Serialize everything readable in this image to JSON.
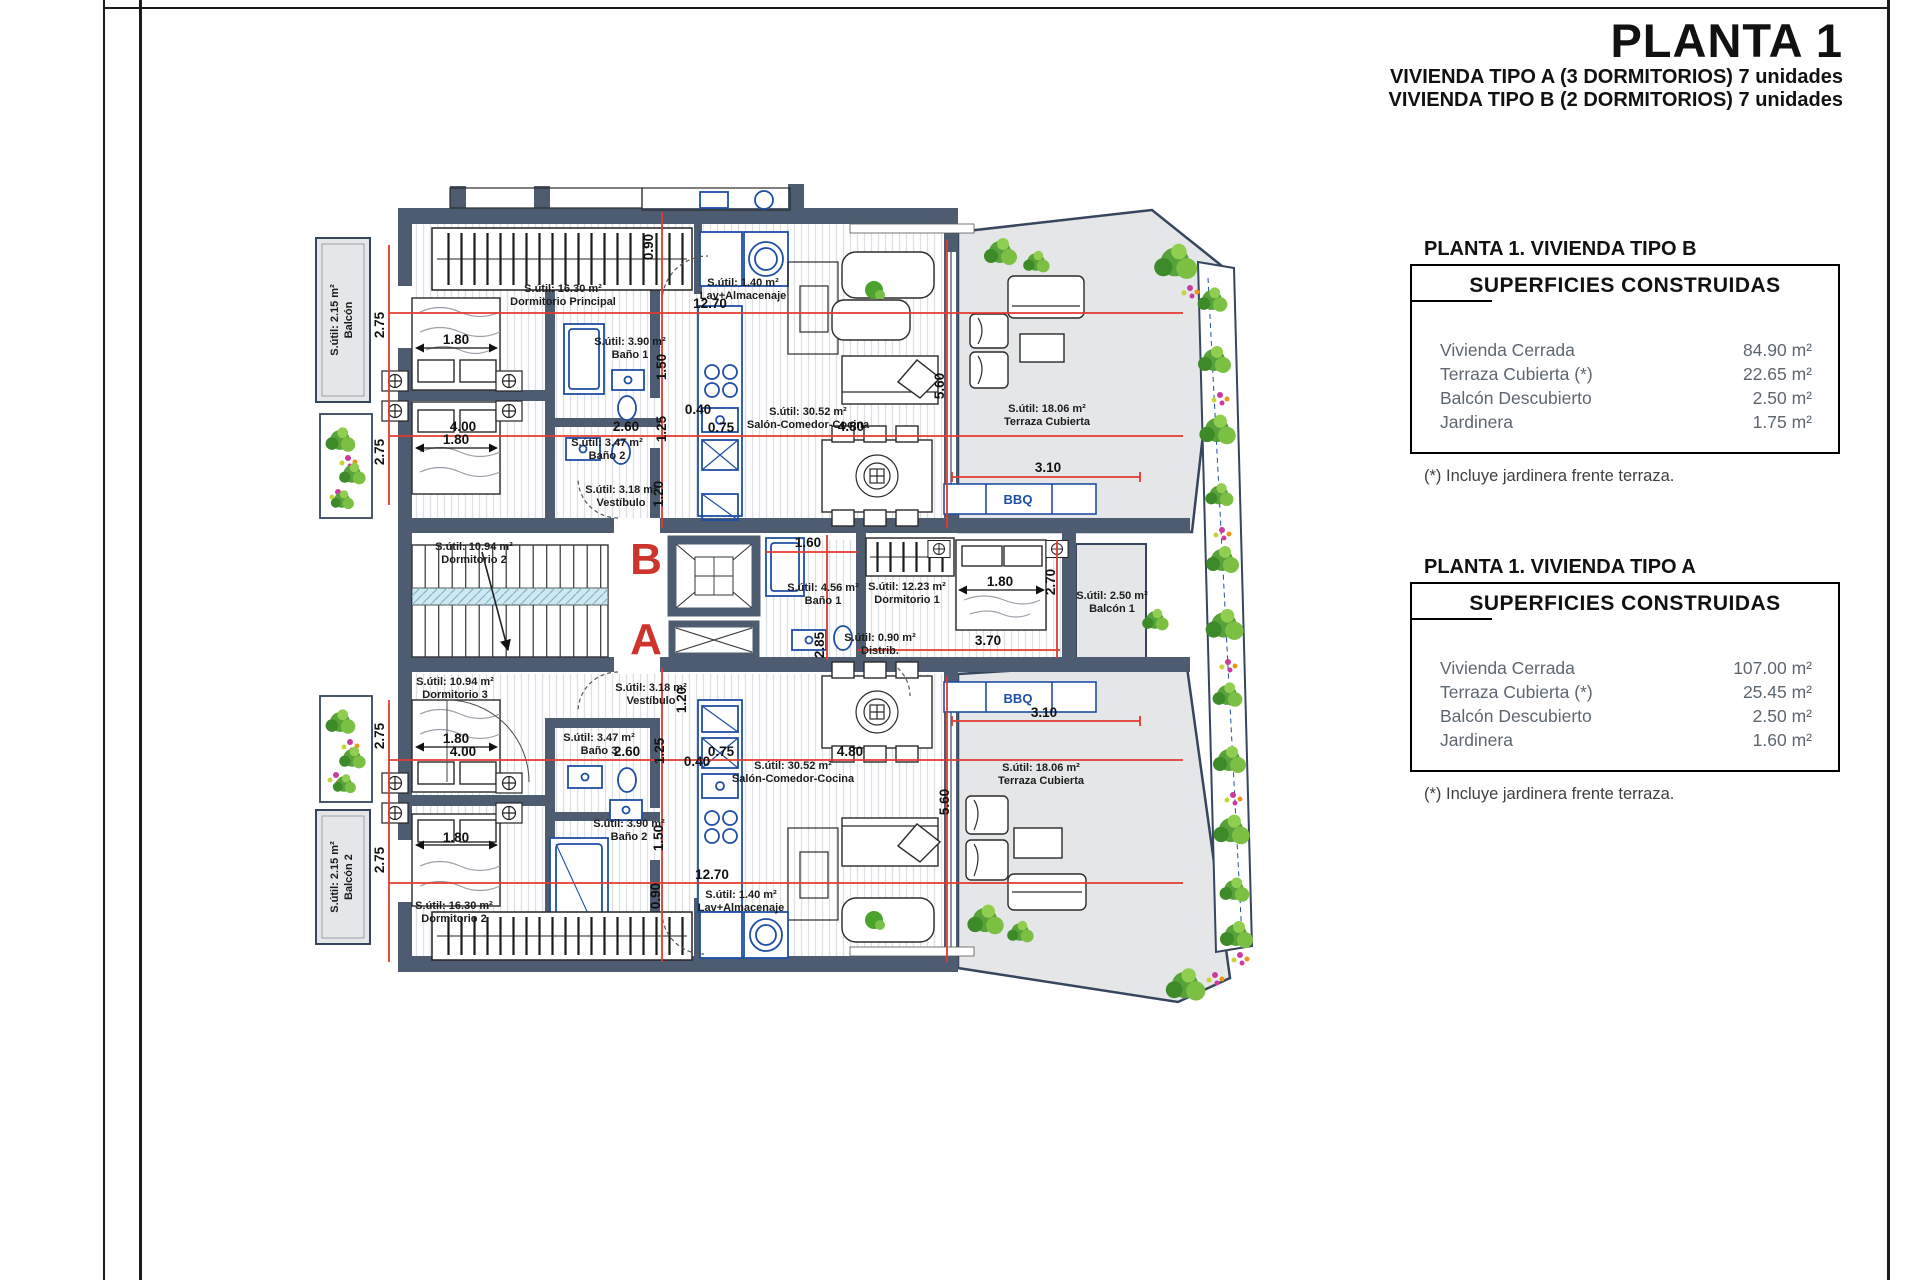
{
  "title_block": {
    "title": "PLANTA 1",
    "subtitle_a": "VIVIENDA TIPO A (3 DORMITORIOS) 7 unidades",
    "subtitle_b": "VIVIENDA TIPO B (2 DORMITORIOS) 7 unidades"
  },
  "tables": [
    {
      "heading": "PLANTA 1. VIVIENDA TIPO B",
      "box_title": "SUPERFICIES CONSTRUIDAS",
      "rows": [
        {
          "label": "Vivienda Cerrada",
          "value": "84.90 m²"
        },
        {
          "label": "Terraza Cubierta (*)",
          "value": "22.65 m²"
        },
        {
          "label": "Balcón Descubierto",
          "value": "2.50 m²"
        },
        {
          "label": "Jardinera",
          "value": "1.75 m²"
        }
      ],
      "footnote": "(*) Incluye jardinera frente terraza."
    },
    {
      "heading": "PLANTA 1. VIVIENDA TIPO A",
      "box_title": "SUPERFICIES CONSTRUIDAS",
      "rows": [
        {
          "label": "Vivienda Cerrada",
          "value": "107.00 m²"
        },
        {
          "label": "Terraza Cubierta (*)",
          "value": "25.45 m²"
        },
        {
          "label": "Balcón Descubierto",
          "value": "2.50 m²"
        },
        {
          "label": "Jardinera",
          "value": "1.60 m²"
        }
      ],
      "footnote": "(*) Incluye jardinera frente terraza."
    }
  ],
  "plan": {
    "unit_letters": [
      {
        "t": "B",
        "x": 646,
        "y": 574
      },
      {
        "t": "A",
        "x": 646,
        "y": 654
      }
    ],
    "bbq": [
      {
        "t": "BBQ",
        "x": 1018,
        "y": 504
      },
      {
        "t": "BBQ",
        "x": 1018,
        "y": 703
      }
    ],
    "vlabels": [
      {
        "l1": "Balcón",
        "l2": "S.útil: 2.15 m²",
        "x": 345,
        "y": 320
      },
      {
        "l1": "Balcón 2",
        "l2": "S.útil: 2.15 m²",
        "x": 345,
        "y": 877
      }
    ],
    "rooms": [
      {
        "a": "S.útil: 16.30 m²",
        "n": "Dormitorio Principal",
        "x": 563,
        "y": 292
      },
      {
        "a": "S.útil: 1.40 m²",
        "n": "Lav+Almacenaje",
        "x": 743,
        "y": 286
      },
      {
        "a": "S.útil: 3.90 m²",
        "n": "Baño 1",
        "x": 630,
        "y": 345
      },
      {
        "a": "S.útil: 3.47 m²",
        "n": "Baño 2",
        "x": 607,
        "y": 446
      },
      {
        "a": "S.útil: 30.52 m²",
        "n": "Salón-Comedor-Cocina",
        "x": 808,
        "y": 415
      },
      {
        "a": "S.útil: 18.06 m²",
        "n": "Terraza Cubierta",
        "x": 1047,
        "y": 412
      },
      {
        "a": "S.útil: 10.94 m²",
        "n": "Dormitorio 2",
        "x": 474,
        "y": 550
      },
      {
        "a": "S.útil: 3.18 m²",
        "n": "Vestíbulo",
        "x": 621,
        "y": 493
      },
      {
        "a": "S.útil: 4.56 m²",
        "n": "Baño 1",
        "x": 823,
        "y": 591
      },
      {
        "a": "S.útil: 12.23 m²",
        "n": "Dormitorio 1",
        "x": 907,
        "y": 590
      },
      {
        "a": "S.útil: 0.90 m²",
        "n": "Distrib.",
        "x": 880,
        "y": 641
      },
      {
        "a": "S.útil: 2.50 m²",
        "n": "Balcón 1",
        "x": 1112,
        "y": 599
      },
      {
        "a": "S.útil: 10.94 m²",
        "n": "Dormitorio 3",
        "x": 455,
        "y": 685
      },
      {
        "a": "S.útil: 3.18 m²",
        "n": "Vestíbulo",
        "x": 651,
        "y": 691
      },
      {
        "a": "S.útil: 3.47 m²",
        "n": "Baño 3",
        "x": 599,
        "y": 741
      },
      {
        "a": "S.útil: 3.90 m²",
        "n": "Baño 2",
        "x": 629,
        "y": 827
      },
      {
        "a": "S.útil: 30.52 m²",
        "n": "Salón-Comedor-Cocina",
        "x": 793,
        "y": 769
      },
      {
        "a": "S.útil: 18.06 m²",
        "n": "Terraza Cubierta",
        "x": 1041,
        "y": 771
      },
      {
        "a": "S.útil: 1.40 m²",
        "n": "Lav+Almacenaje",
        "x": 741,
        "y": 898
      },
      {
        "a": "S.útil: 16.30 m²",
        "n": "Dormitorio 2",
        "x": 454,
        "y": 909
      }
    ],
    "dims": [
      {
        "t": "12.70",
        "x": 710,
        "y": 308
      },
      {
        "t": "0.90",
        "x": 653,
        "y": 247,
        "r": -90
      },
      {
        "t": "2.75",
        "x": 384,
        "y": 325,
        "r": -90
      },
      {
        "t": "1.80",
        "x": 456,
        "y": 344
      },
      {
        "t": "1.50",
        "x": 666,
        "y": 367,
        "r": -90
      },
      {
        "t": "0.40",
        "x": 698,
        "y": 414
      },
      {
        "t": "1.25",
        "x": 666,
        "y": 429,
        "r": -90
      },
      {
        "t": "4.00",
        "x": 463,
        "y": 431
      },
      {
        "t": "2.60",
        "x": 626,
        "y": 431
      },
      {
        "t": "0.75",
        "x": 721,
        "y": 432
      },
      {
        "t": "4.80",
        "x": 851,
        "y": 431
      },
      {
        "t": "1.80",
        "x": 456,
        "y": 444
      },
      {
        "t": "2.75",
        "x": 384,
        "y": 452,
        "r": -90
      },
      {
        "t": "3.10",
        "x": 1048,
        "y": 472
      },
      {
        "t": "5.60",
        "x": 944,
        "y": 386,
        "r": -90
      },
      {
        "t": "1.20",
        "x": 663,
        "y": 494,
        "r": -90
      },
      {
        "t": "1.60",
        "x": 808,
        "y": 547
      },
      {
        "t": "1.80",
        "x": 1000,
        "y": 586
      },
      {
        "t": "2.70",
        "x": 1055,
        "y": 582,
        "r": -90
      },
      {
        "t": "2.85",
        "x": 824,
        "y": 645,
        "r": -90
      },
      {
        "t": "3.70",
        "x": 988,
        "y": 645
      },
      {
        "t": "1.20",
        "x": 686,
        "y": 700,
        "r": -90
      },
      {
        "t": "3.10",
        "x": 1044,
        "y": 717
      },
      {
        "t": "2.75",
        "x": 384,
        "y": 736,
        "r": -90
      },
      {
        "t": "1.80",
        "x": 456,
        "y": 743
      },
      {
        "t": "1.25",
        "x": 664,
        "y": 751,
        "r": -90
      },
      {
        "t": "4.00",
        "x": 463,
        "y": 756
      },
      {
        "t": "2.60",
        "x": 627,
        "y": 756
      },
      {
        "t": "0.75",
        "x": 721,
        "y": 756
      },
      {
        "t": "4.80",
        "x": 850,
        "y": 756
      },
      {
        "t": "0.40",
        "x": 697,
        "y": 766
      },
      {
        "t": "1.80",
        "x": 456,
        "y": 842
      },
      {
        "t": "1.50",
        "x": 663,
        "y": 838,
        "r": -90
      },
      {
        "t": "2.75",
        "x": 384,
        "y": 860,
        "r": -90
      },
      {
        "t": "12.70",
        "x": 712,
        "y": 879
      },
      {
        "t": "0.90",
        "x": 660,
        "y": 896,
        "r": -90
      },
      {
        "t": "5.60",
        "x": 949,
        "y": 802,
        "r": -90
      }
    ]
  },
  "colors": {
    "wall": "#4e5c71",
    "fixture_blue": "#1e4fa5",
    "dim_red": "#e23b2e",
    "letter_red": "#cf342c",
    "terrace_gray": "#e4e6e8",
    "table_text": "#5d6771"
  }
}
